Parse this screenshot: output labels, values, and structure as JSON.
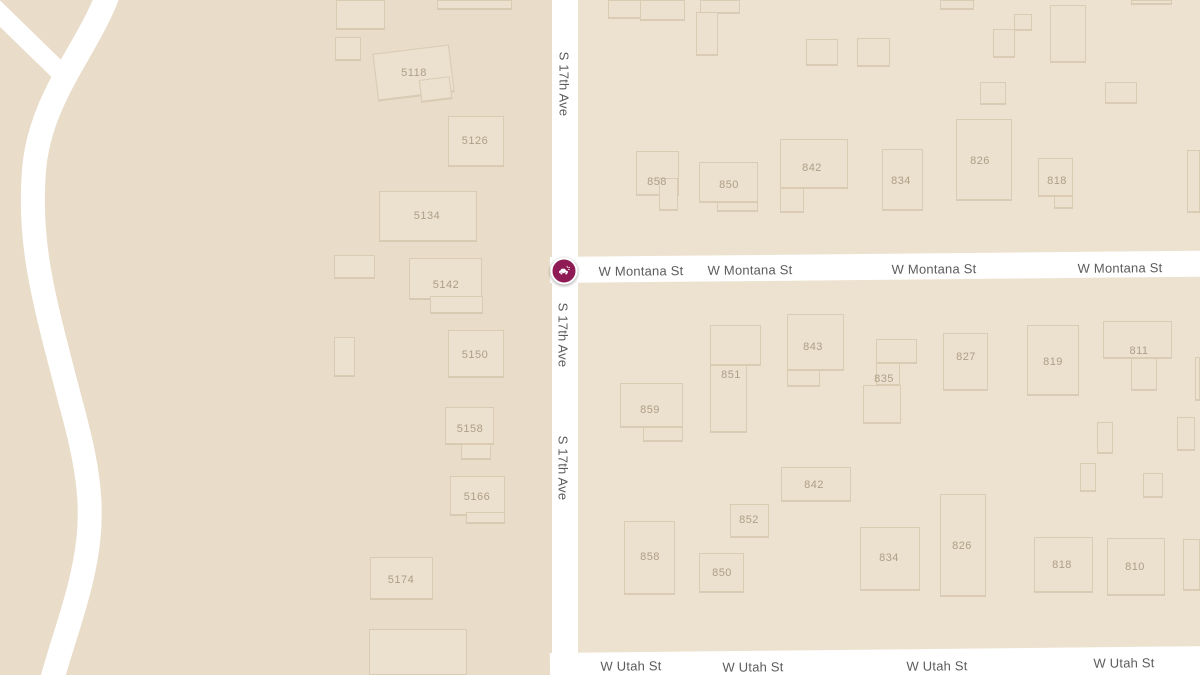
{
  "map": {
    "colors": {
      "land": "#e9dcc8",
      "block": "#ede2d0",
      "building_fill": "#ece1cf",
      "building_border": "#d0c0a5",
      "road": "#ffffff",
      "street_label": "#5c5c5c",
      "building_number": "#ae9e86",
      "marker": "#8e1b54"
    },
    "marker": {
      "icon": "car-crash-icon",
      "x": 564,
      "y": 271,
      "color": "#8e1b54"
    },
    "street_labels": [
      {
        "text": "S 17th Ave",
        "x": 564,
        "y": 84,
        "orientation": "v"
      },
      {
        "text": "S 17th Ave",
        "x": 563,
        "y": 335,
        "orientation": "v"
      },
      {
        "text": "S 17th Ave",
        "x": 563,
        "y": 468,
        "orientation": "v"
      },
      {
        "text": "W Montana St",
        "x": 641,
        "y": 271,
        "orientation": "h"
      },
      {
        "text": "W Montana St",
        "x": 750,
        "y": 270,
        "orientation": "h"
      },
      {
        "text": "W Montana St",
        "x": 934,
        "y": 269,
        "orientation": "h"
      },
      {
        "text": "W Montana St",
        "x": 1120,
        "y": 268,
        "orientation": "h"
      },
      {
        "text": "W Utah St",
        "x": 631,
        "y": 666,
        "orientation": "h"
      },
      {
        "text": "W Utah St",
        "x": 753,
        "y": 667,
        "orientation": "h"
      },
      {
        "text": "W Utah St",
        "x": 937,
        "y": 666,
        "orientation": "h"
      },
      {
        "text": "W Utah St",
        "x": 1124,
        "y": 663,
        "orientation": "h"
      }
    ],
    "buildings": [
      {
        "parts": [
          [
            336,
            0,
            49,
            29
          ]
        ]
      },
      {
        "parts": [
          [
            335,
            37,
            26,
            23
          ]
        ]
      },
      {
        "parts": [
          [
            437,
            0,
            75,
            9
          ]
        ]
      },
      {
        "label": "5118",
        "lx": 414,
        "ly": 73,
        "parts": [
          [
            375,
            49,
            77,
            47,
            -7
          ],
          [
            420,
            78,
            31,
            22,
            -7
          ]
        ]
      },
      {
        "label": "5126",
        "lx": 475,
        "ly": 141,
        "parts": [
          [
            448,
            116,
            56,
            50
          ]
        ]
      },
      {
        "label": "5134",
        "lx": 427,
        "ly": 216,
        "parts": [
          [
            379,
            191,
            98,
            50
          ]
        ]
      },
      {
        "parts": [
          [
            334,
            255,
            41,
            23
          ]
        ]
      },
      {
        "label": "5142",
        "lx": 446,
        "ly": 285,
        "parts": [
          [
            409,
            258,
            73,
            41
          ],
          [
            430,
            296,
            53,
            17
          ]
        ]
      },
      {
        "parts": [
          [
            334,
            337,
            21,
            39
          ]
        ]
      },
      {
        "label": "5150",
        "lx": 475,
        "ly": 355,
        "parts": [
          [
            448,
            330,
            56,
            47
          ]
        ]
      },
      {
        "label": "5158",
        "lx": 470,
        "ly": 429,
        "parts": [
          [
            445,
            407,
            49,
            37
          ],
          [
            461,
            444,
            30,
            15
          ]
        ]
      },
      {
        "label": "5166",
        "lx": 477,
        "ly": 497,
        "parts": [
          [
            450,
            476,
            55,
            39
          ],
          [
            466,
            512,
            39,
            11
          ]
        ]
      },
      {
        "label": "5174",
        "lx": 401,
        "ly": 580,
        "parts": [
          [
            370,
            557,
            63,
            42
          ]
        ]
      },
      {
        "parts": [
          [
            369,
            629,
            98,
            46
          ]
        ]
      },
      {
        "parts": [
          [
            608,
            0,
            33,
            18
          ]
        ]
      },
      {
        "parts": [
          [
            640,
            0,
            45,
            20
          ]
        ]
      },
      {
        "parts": [
          [
            700,
            0,
            40,
            13
          ]
        ]
      },
      {
        "parts": [
          [
            696,
            12,
            22,
            43
          ]
        ]
      },
      {
        "parts": [
          [
            806,
            39,
            32,
            26
          ]
        ]
      },
      {
        "parts": [
          [
            857,
            38,
            33,
            28
          ]
        ]
      },
      {
        "parts": [
          [
            940,
            0,
            34,
            9
          ]
        ]
      },
      {
        "parts": [
          [
            1014,
            14,
            18,
            16
          ]
        ]
      },
      {
        "parts": [
          [
            993,
            29,
            22,
            28
          ]
        ]
      },
      {
        "parts": [
          [
            1050,
            5,
            36,
            57
          ]
        ]
      },
      {
        "parts": [
          [
            1131,
            0,
            41,
            4
          ]
        ]
      },
      {
        "parts": [
          [
            980,
            82,
            26,
            22
          ]
        ]
      },
      {
        "parts": [
          [
            1105,
            82,
            32,
            21
          ]
        ]
      },
      {
        "parts": [
          [
            1187,
            150,
            13,
            62
          ]
        ]
      },
      {
        "label": "858",
        "lx": 657,
        "ly": 182,
        "parts": [
          [
            636,
            151,
            43,
            44
          ],
          [
            659,
            178,
            19,
            32
          ]
        ]
      },
      {
        "label": "850",
        "lx": 729,
        "ly": 185,
        "parts": [
          [
            699,
            162,
            59,
            40
          ],
          [
            717,
            202,
            41,
            9
          ]
        ]
      },
      {
        "label": "842",
        "lx": 812,
        "ly": 168,
        "parts": [
          [
            780,
            139,
            68,
            49
          ],
          [
            780,
            188,
            24,
            24
          ]
        ]
      },
      {
        "label": "834",
        "lx": 901,
        "ly": 181,
        "parts": [
          [
            882,
            149,
            41,
            61
          ]
        ]
      },
      {
        "label": "826",
        "lx": 980,
        "ly": 161,
        "parts": [
          [
            956,
            119,
            56,
            81
          ]
        ]
      },
      {
        "label": "818",
        "lx": 1057,
        "ly": 181,
        "parts": [
          [
            1038,
            158,
            35,
            38
          ],
          [
            1054,
            196,
            19,
            12
          ]
        ]
      },
      {
        "label": "859",
        "lx": 650,
        "ly": 410,
        "parts": [
          [
            620,
            383,
            63,
            44
          ],
          [
            643,
            427,
            40,
            14
          ]
        ]
      },
      {
        "label": "851",
        "lx": 731,
        "ly": 375,
        "parts": [
          [
            710,
            325,
            51,
            40
          ],
          [
            710,
            365,
            37,
            67
          ]
        ]
      },
      {
        "label": "843",
        "lx": 813,
        "ly": 347,
        "parts": [
          [
            787,
            314,
            57,
            56
          ],
          [
            787,
            370,
            33,
            16
          ]
        ]
      },
      {
        "label": "835",
        "lx": 884,
        "ly": 379,
        "parts": [
          [
            876,
            339,
            41,
            24
          ],
          [
            876,
            363,
            24,
            22
          ],
          [
            863,
            385,
            38,
            38
          ]
        ]
      },
      {
        "label": "827",
        "lx": 966,
        "ly": 357,
        "parts": [
          [
            943,
            333,
            45,
            57
          ]
        ]
      },
      {
        "label": "819",
        "lx": 1053,
        "ly": 362,
        "parts": [
          [
            1027,
            325,
            52,
            70
          ]
        ]
      },
      {
        "label": "811",
        "lx": 1139,
        "ly": 351,
        "parts": [
          [
            1103,
            321,
            69,
            37
          ],
          [
            1131,
            358,
            26,
            32
          ]
        ]
      },
      {
        "parts": [
          [
            1097,
            422,
            16,
            31
          ]
        ]
      },
      {
        "parts": [
          [
            1177,
            417,
            18,
            33
          ]
        ]
      },
      {
        "parts": [
          [
            1080,
            463,
            16,
            28
          ]
        ]
      },
      {
        "parts": [
          [
            1143,
            473,
            20,
            24
          ]
        ]
      },
      {
        "parts": [
          [
            1195,
            357,
            5,
            43
          ]
        ]
      },
      {
        "label": "842",
        "lx": 814,
        "ly": 485,
        "parts": [
          [
            781,
            467,
            70,
            34
          ]
        ]
      },
      {
        "label": "852",
        "lx": 749,
        "ly": 520,
        "parts": [
          [
            730,
            504,
            39,
            33
          ]
        ]
      },
      {
        "label": "858",
        "lx": 650,
        "ly": 557,
        "parts": [
          [
            624,
            521,
            51,
            73
          ]
        ]
      },
      {
        "label": "850",
        "lx": 722,
        "ly": 573,
        "parts": [
          [
            699,
            553,
            45,
            39
          ]
        ]
      },
      {
        "label": "834",
        "lx": 889,
        "ly": 558,
        "parts": [
          [
            860,
            527,
            60,
            63
          ]
        ]
      },
      {
        "label": "826",
        "lx": 962,
        "ly": 546,
        "parts": [
          [
            940,
            494,
            46,
            102
          ]
        ]
      },
      {
        "label": "818",
        "lx": 1062,
        "ly": 565,
        "parts": [
          [
            1034,
            537,
            59,
            55
          ]
        ]
      },
      {
        "label": "810",
        "lx": 1135,
        "ly": 567,
        "parts": [
          [
            1107,
            538,
            58,
            57
          ]
        ]
      },
      {
        "parts": [
          [
            1183,
            539,
            17,
            51
          ]
        ]
      }
    ]
  }
}
